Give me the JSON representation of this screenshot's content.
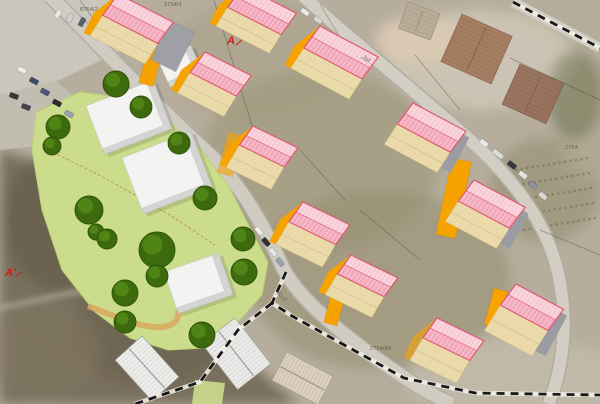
{
  "map": {
    "markers": [
      {
        "text": "A",
        "x": 227,
        "y": 44,
        "tick": [
          236,
          45,
          242,
          40
        ]
      },
      {
        "text": "A'",
        "x": 5,
        "y": 276,
        "tick": [
          15,
          277,
          21,
          272
        ]
      }
    ],
    "street_labels": [
      {
        "text": "Roz...",
        "x": 276,
        "y": 294,
        "rot": 42
      },
      {
        "text": "Jat...",
        "x": 361,
        "y": 58,
        "rot": 33
      }
    ],
    "parcel_labels": [
      {
        "text": "8754/2",
        "x": 80,
        "y": 11
      },
      {
        "text": "2754/1",
        "x": 164,
        "y": 6
      },
      {
        "text": "2754",
        "x": 565,
        "y": 149
      },
      {
        "text": "2754/64",
        "x": 370,
        "y": 350
      }
    ],
    "colors": {
      "roof_light": "#f7cbd5",
      "roof_dark": "#f1a9bb",
      "roof_edge": "#e0556a",
      "cream_wall": "#ebdaa9",
      "orange": "#f6a300",
      "gray_wall": "#9b9ba3",
      "tree": "#3e6a0e",
      "tree_hi": "#548c17",
      "tree_edge": "#2d5207",
      "site_green": "#cbdd8c",
      "white_top": "#f3f3f1",
      "white_side": "#d4d4d2",
      "boundary": "#191919",
      "marker_red": "#cf1d1d"
    },
    "proposed_buildings": [
      {
        "x": 118,
        "y": -6,
        "rot": 27,
        "L": 62,
        "D": 26,
        "wall": 24,
        "end": "orange"
      },
      {
        "x": 243,
        "y": -14,
        "rot": 27,
        "L": 60,
        "D": 26,
        "wall": 22,
        "end": "orange"
      },
      {
        "x": 320,
        "y": 26,
        "rot": 28,
        "L": 66,
        "D": 27,
        "wall": 24,
        "end": "orange"
      },
      {
        "x": 413,
        "y": 103,
        "rot": 28,
        "L": 60,
        "D": 26,
        "wall": 24,
        "end": "gray"
      },
      {
        "x": 474,
        "y": 180,
        "rot": 28,
        "L": 58,
        "D": 26,
        "wall": 24,
        "end": "gray"
      },
      {
        "x": 516,
        "y": 284,
        "rot": 28,
        "L": 54,
        "D": 26,
        "wall": 30,
        "end": "gray"
      },
      {
        "x": 437,
        "y": 318,
        "rot": 26,
        "L": 52,
        "D": 24,
        "wall": 26,
        "end": "yellow"
      },
      {
        "x": 351,
        "y": 255,
        "rot": 26,
        "L": 52,
        "D": 23,
        "wall": 24,
        "end": "orange"
      },
      {
        "x": 205,
        "y": 52,
        "rot": 27,
        "L": 52,
        "D": 25,
        "wall": 24,
        "end": "orange"
      },
      {
        "x": 253,
        "y": 126,
        "rot": 26,
        "L": 50,
        "D": 23,
        "wall": 26,
        "end": "orange"
      },
      {
        "x": 303,
        "y": 202,
        "rot": 26,
        "L": 52,
        "D": 24,
        "wall": 26,
        "end": "orange"
      }
    ],
    "orange_towers": [
      {
        "x": 148,
        "y": 48,
        "w": 15,
        "h": 36,
        "rot": 15
      },
      {
        "x": 452,
        "y": 158,
        "w": 20,
        "h": 78,
        "rot": 12
      },
      {
        "x": 494,
        "y": 288,
        "w": 14,
        "h": 38,
        "rot": 15
      },
      {
        "x": 336,
        "y": 276,
        "w": 14,
        "h": 48,
        "rot": 15
      },
      {
        "x": 228,
        "y": 132,
        "w": 16,
        "h": 42,
        "rot": 15,
        "opacity": 0.6
      },
      {
        "x": 170,
        "y": 20,
        "w": 28,
        "h": 44,
        "rot": 26,
        "color": "#9fa0a6"
      }
    ],
    "white_buildings": [
      {
        "x": 86,
        "y": 106,
        "w": 72,
        "h": 52,
        "rot": -21
      },
      {
        "x": 122,
        "y": 158,
        "w": 74,
        "h": 60,
        "rot": -21
      },
      {
        "x": 164,
        "y": 272,
        "w": 58,
        "h": 44,
        "rot": -19
      },
      {
        "x": 158,
        "y": 60,
        "w": 36,
        "h": 30,
        "rot": -24
      }
    ],
    "existing_model_houses": [
      {
        "x": 235,
        "y": 318,
        "L": 58,
        "D": 42,
        "rot": 52,
        "roof": "#eaeae8",
        "hatch": "#b7b7b4"
      },
      {
        "x": 142,
        "y": 336,
        "L": 55,
        "D": 36,
        "rot": 48,
        "roof": "#ececea",
        "hatch": "#bcbcb9"
      },
      {
        "x": 287,
        "y": 352,
        "L": 52,
        "D": 32,
        "rot": 28,
        "roof": "#dccfbd",
        "hatch": "#b09a84"
      }
    ],
    "existing_aerial_houses": [
      {
        "x": 462,
        "y": 14,
        "w": 55,
        "h": 52,
        "rot": 24,
        "color": "#a37a5e",
        "hatch": "#7c5a44"
      },
      {
        "x": 520,
        "y": 64,
        "w": 48,
        "h": 44,
        "rot": 24,
        "color": "#97705a",
        "hatch": "#715245"
      },
      {
        "x": 408,
        "y": 2,
        "w": 34,
        "h": 28,
        "rot": 20,
        "color": "#b8ab97",
        "hatch": "#938974"
      }
    ],
    "trees": [
      {
        "x": 116,
        "y": 84,
        "r": 13
      },
      {
        "x": 141,
        "y": 107,
        "r": 11
      },
      {
        "x": 58,
        "y": 127,
        "r": 12
      },
      {
        "x": 52,
        "y": 146,
        "r": 9
      },
      {
        "x": 179,
        "y": 143,
        "r": 11
      },
      {
        "x": 205,
        "y": 198,
        "r": 12
      },
      {
        "x": 89,
        "y": 210,
        "r": 14
      },
      {
        "x": 96,
        "y": 232,
        "r": 8
      },
      {
        "x": 107,
        "y": 239,
        "r": 10
      },
      {
        "x": 157,
        "y": 250,
        "r": 18
      },
      {
        "x": 243,
        "y": 239,
        "r": 12
      },
      {
        "x": 157,
        "y": 276,
        "r": 11
      },
      {
        "x": 125,
        "y": 293,
        "r": 13
      },
      {
        "x": 125,
        "y": 322,
        "r": 11
      },
      {
        "x": 202,
        "y": 335,
        "r": 13
      },
      {
        "x": 244,
        "y": 272,
        "r": 13
      }
    ],
    "cars": [
      {
        "x": 58,
        "y": 14,
        "rot": 118,
        "color": "#e6e6e4"
      },
      {
        "x": 70,
        "y": 18,
        "rot": 118,
        "color": "#cfd2d6"
      },
      {
        "x": 82,
        "y": 22,
        "rot": 118,
        "color": "#5a6270"
      },
      {
        "x": 94,
        "y": 26,
        "rot": 118,
        "color": "#e2e2e0"
      },
      {
        "x": 104,
        "y": 30,
        "rot": 118,
        "color": "#343a44"
      },
      {
        "x": 22,
        "y": 70,
        "rot": 28,
        "color": "#ececea"
      },
      {
        "x": 34,
        "y": 81,
        "rot": 28,
        "color": "#3d4c6a"
      },
      {
        "x": 45,
        "y": 92,
        "rot": 28,
        "color": "#49597a"
      },
      {
        "x": 57,
        "y": 103,
        "rot": 28,
        "color": "#2d2d31"
      },
      {
        "x": 69,
        "y": 114,
        "rot": 28,
        "color": "#9aa0ac"
      },
      {
        "x": 14,
        "y": 96,
        "rot": 20,
        "color": "#36363a"
      },
      {
        "x": 26,
        "y": 107,
        "rot": 20,
        "color": "#44444a"
      },
      {
        "x": 305,
        "y": 12,
        "rot": 35,
        "color": "#e8e8e6"
      },
      {
        "x": 318,
        "y": 20,
        "rot": 35,
        "color": "#d6d6d4"
      },
      {
        "x": 259,
        "y": 231,
        "rot": 50,
        "color": "#ebebe9"
      },
      {
        "x": 266,
        "y": 242,
        "rot": 50,
        "color": "#303036"
      },
      {
        "x": 273,
        "y": 252,
        "rot": 50,
        "color": "#e3e3e1"
      },
      {
        "x": 280,
        "y": 262,
        "rot": 50,
        "color": "#9aa2ae"
      },
      {
        "x": 484,
        "y": 143,
        "rot": 38,
        "color": "#e9e9e7"
      },
      {
        "x": 498,
        "y": 154,
        "rot": 38,
        "color": "#dcdcda",
        "len": 12
      },
      {
        "x": 512,
        "y": 165,
        "rot": 38,
        "color": "#32363e"
      },
      {
        "x": 523,
        "y": 175,
        "rot": 38,
        "color": "#e4e4e2"
      },
      {
        "x": 533,
        "y": 185,
        "rot": 38,
        "color": "#8e949e"
      },
      {
        "x": 543,
        "y": 196,
        "rot": 40,
        "color": "#d8d8d6"
      }
    ],
    "cadastral_lines": [
      [
        214,
        0,
        252,
        126
      ],
      [
        320,
        4,
        352,
        58
      ],
      [
        415,
        55,
        460,
        110
      ],
      [
        510,
        58,
        600,
        100
      ],
      [
        540,
        230,
        600,
        255
      ],
      [
        300,
        150,
        345,
        200
      ],
      [
        360,
        210,
        420,
        260
      ],
      [
        80,
        0,
        108,
        40
      ]
    ]
  }
}
